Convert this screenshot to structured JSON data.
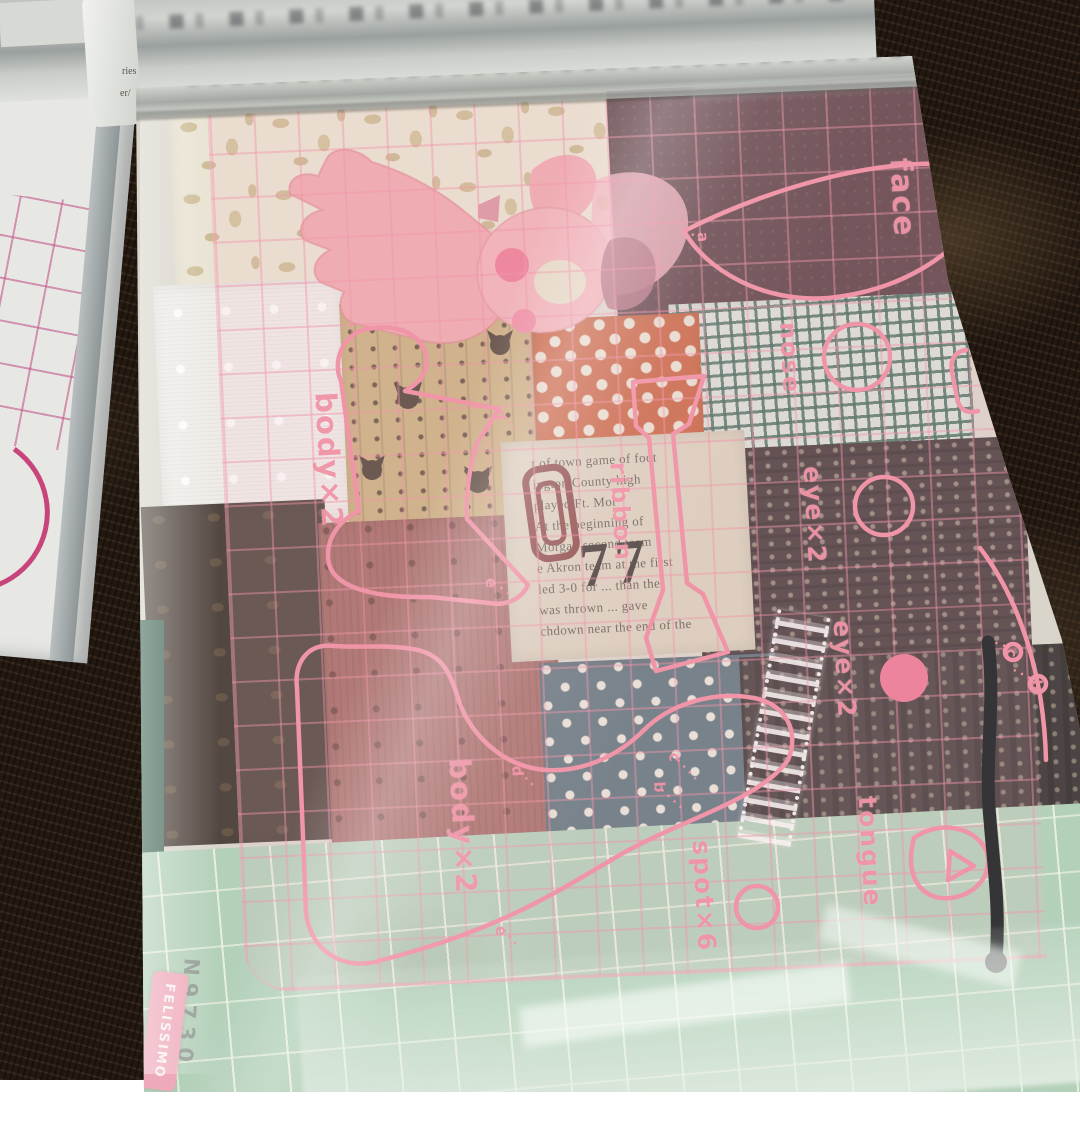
{
  "template_sheet": {
    "labels": {
      "face": "face",
      "nose": "nose",
      "eye": "eye×2",
      "ribbon": "ribbon",
      "body": "body×2",
      "tongue": "tongue",
      "spot": "spot×6"
    },
    "markers": {
      "a": "a",
      "b": "b",
      "c": "c",
      "d": "d",
      "e": "e"
    }
  },
  "packaging": {
    "brand": "FELISSIMO",
    "product_code": "N9730"
  },
  "background_papers": {
    "fragments": [
      "ries",
      "er/"
    ]
  },
  "newspaper_fabric": {
    "big_number": "77",
    "lines": [
      "t of town game of foot",
      "ington County high",
      "played        Ft. Mor",
      "At the beginning of",
      "Morgan second team",
      "e Akron team at the first",
      "led 3-0 for ... than the",
      "was thrown ... gave",
      "chdown near the end of the"
    ]
  },
  "colors": {
    "template_pink": "#f2879e",
    "grid_pink": "#f59ab0",
    "pompom_pink": "#ee7492",
    "badge_pink": "#f0a0b4",
    "green_fabric": "#abcdb3",
    "carpet_brown": "#231911",
    "cord_black": "#17171a"
  }
}
